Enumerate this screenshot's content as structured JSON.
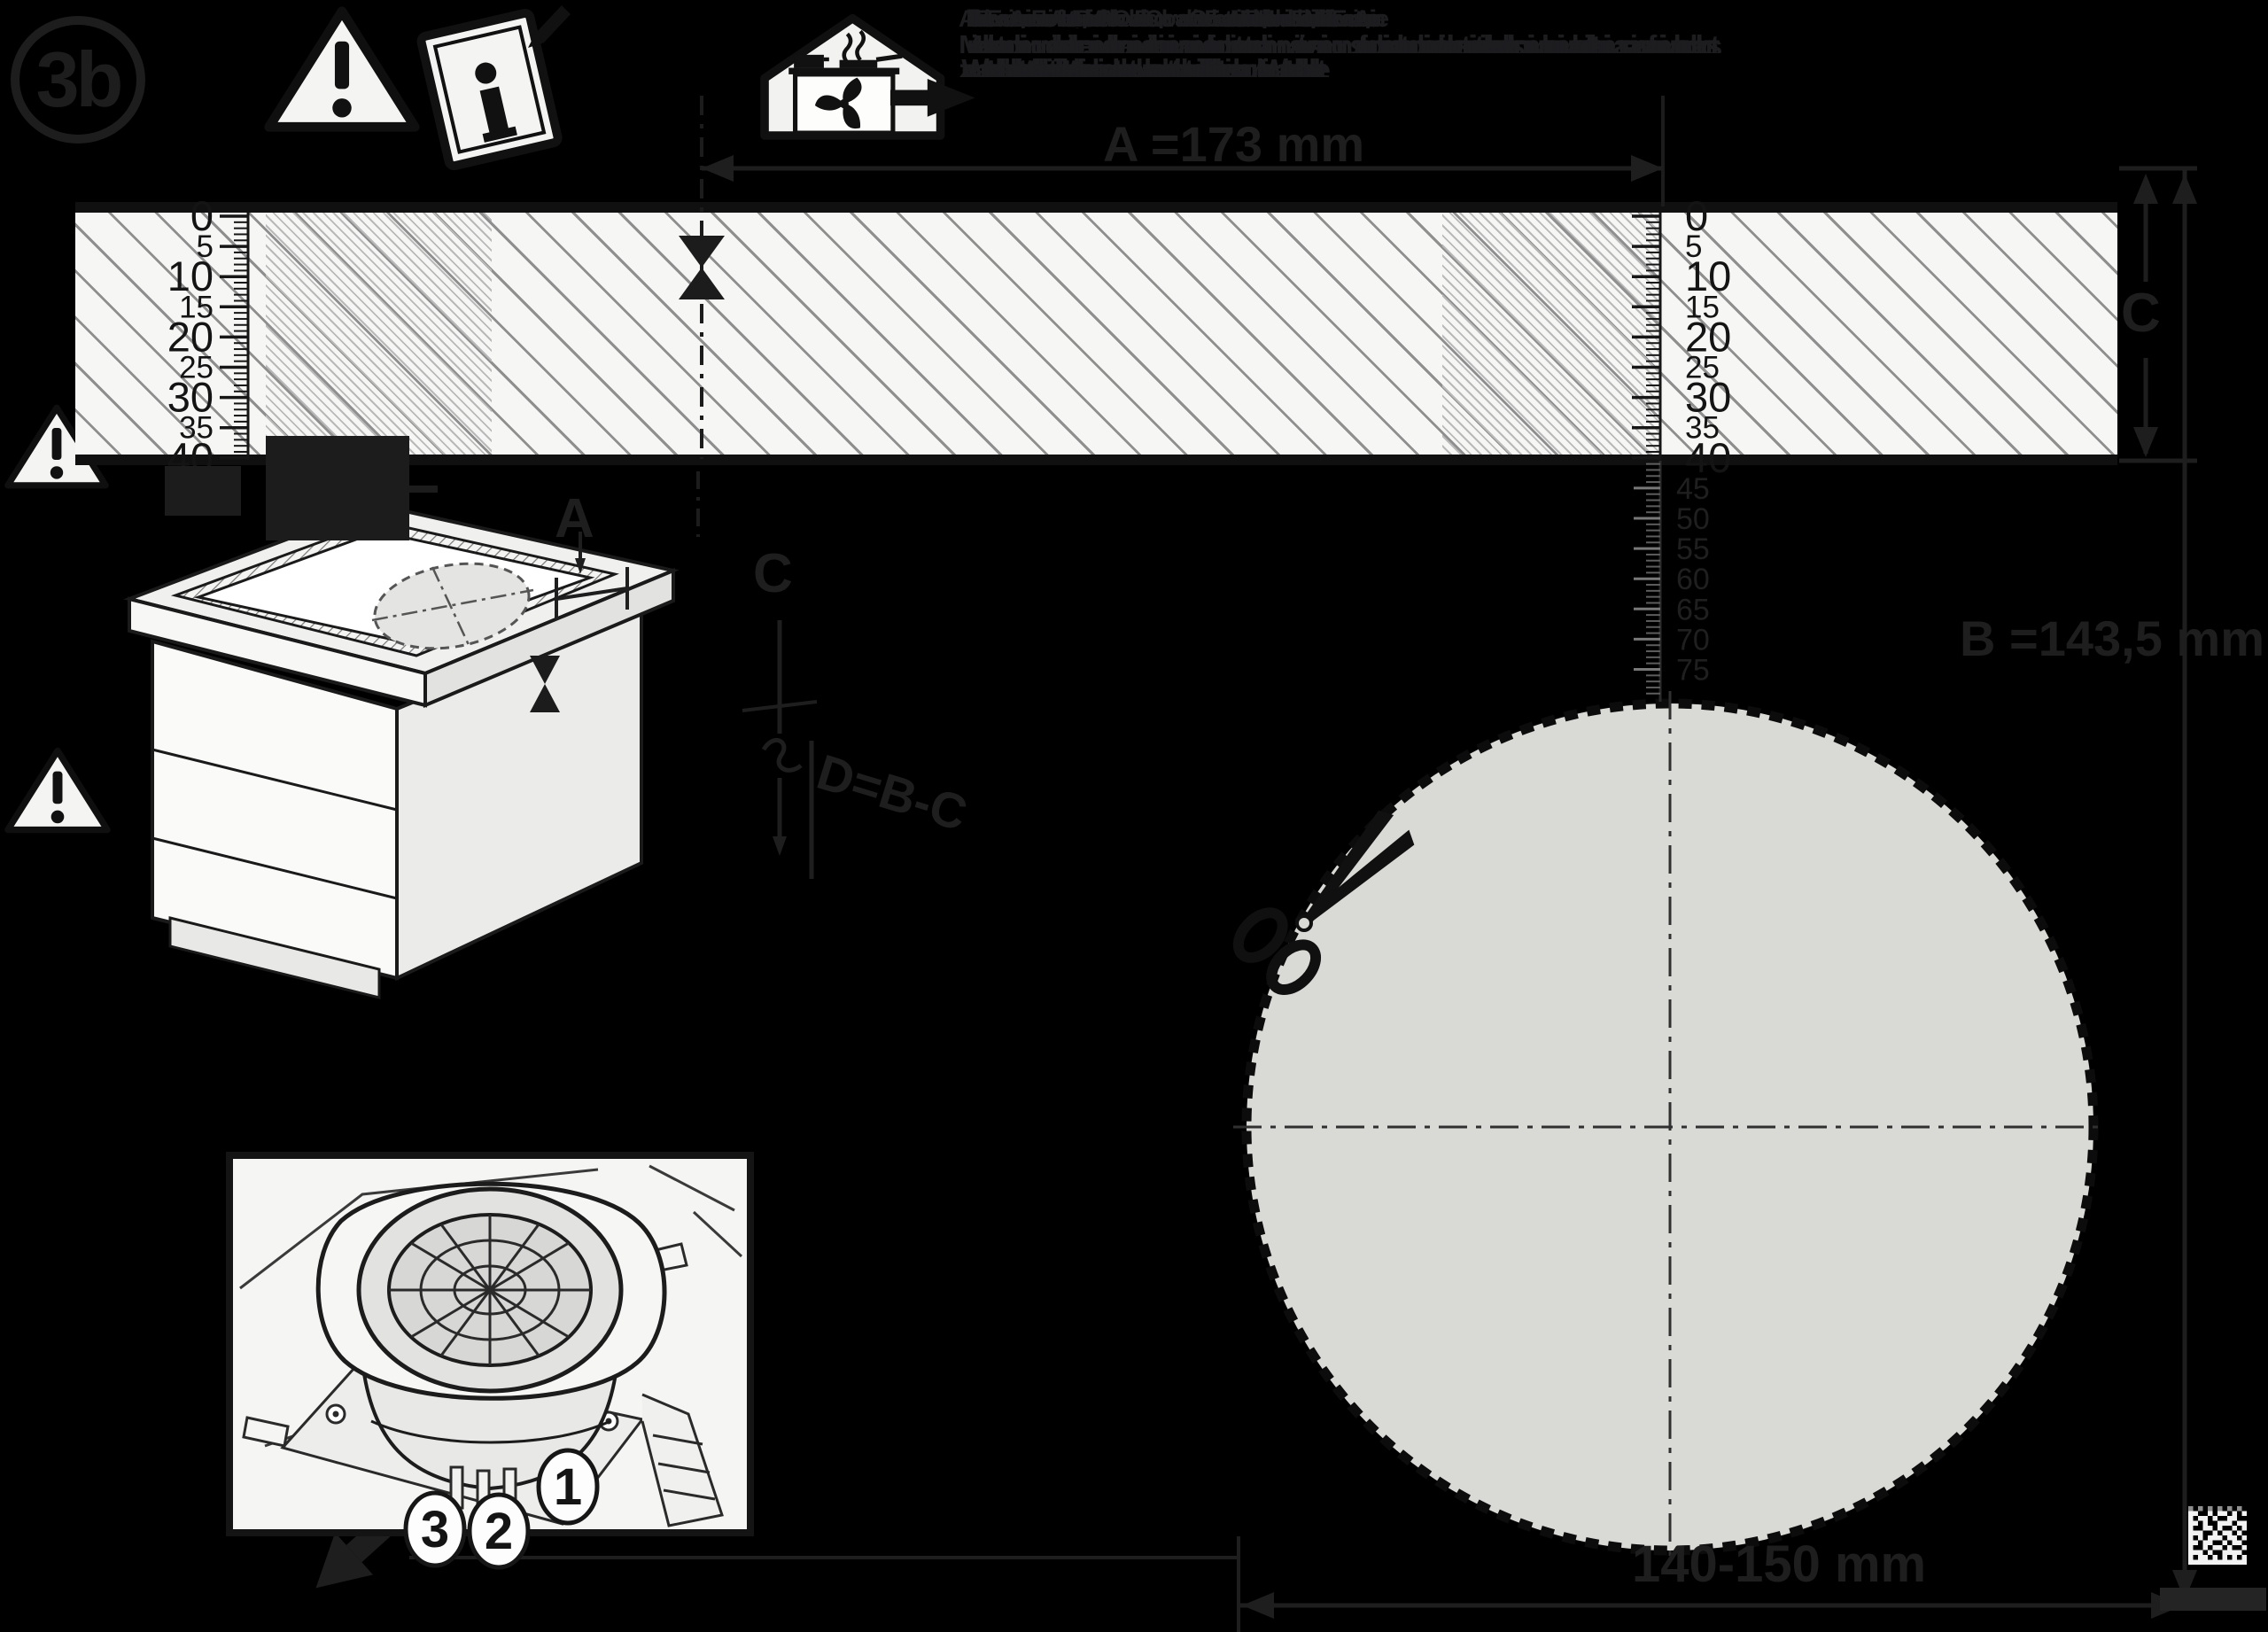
{
  "colors": {
    "background": "#000000",
    "ink_on_black": "#1e1e1e",
    "paper": "#f6f6f4",
    "template_circle_fill": "#d9dad6"
  },
  "badge": {
    "step_label": "3b"
  },
  "icons": {
    "warning_mark": "!",
    "info_mark": "i"
  },
  "instructions": {
    "illegible_line1": "Abluftbetrieb Extraction Evacuation Aspirazione Extraccion Afvoer Utsug Poistoilma Aftraek Avtrekk Odvod Elszivas Odprowadzenie Otvod Exaustao Aerisire Vetranie Tuuletus Ventilacija Havalandirma Ekstrakcja Ventilation Abluft Extraction Evacuation Aspirazione",
    "illegible_line2": "Mindestabstand minimum distance distance minimale distanza minima distancia minima minimale afstand minsta avstand vahimmaisetaisyys minimumsafstand minimal avstand minimalni vzdalenost minimalis tavolsag odleglosc minimalna minimalna razdalja distanta minima asgari mesafe minimalna oddalenost",
    "illegible_line3": "zur Wand to the wall au mur alla parete a la pared tot de wand till vagg seinaan til vaeg til vegg ke stene a falhoz do sciany do steny la perete duvara kadar pros ton toicho k stene do zdi fino alla parete hasta la pared jusqu au mur bis zur Wand to the wall au mur alla parete"
  },
  "dims": {
    "a": "A =173 mm",
    "b": "B =143,5 mm",
    "c": "C",
    "cab_a": "A",
    "cab_c": "C",
    "formula": "D=B-C",
    "hole": "140-150 mm"
  },
  "rulers": {
    "band_labels": [
      "0",
      "5",
      "10",
      "15",
      "20",
      "25",
      "30",
      "35",
      "40"
    ],
    "ext_labels": [
      "45",
      "50",
      "55",
      "60",
      "65",
      "70",
      "75"
    ]
  },
  "inset": {
    "callouts": [
      "1",
      "2",
      "3"
    ]
  },
  "datamatrix": {
    "rows": [
      "101010101010",
      "110010110101",
      "101101001100",
      "110100111011",
      "100110100101",
      "111001011010",
      "101011101101",
      "110110010110",
      "100101101001",
      "111010011110",
      "101101010101",
      "111111111111"
    ]
  }
}
